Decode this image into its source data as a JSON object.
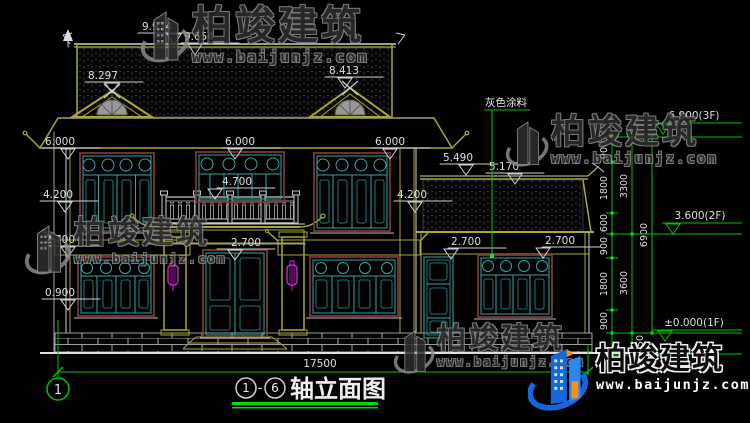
{
  "colors": {
    "background": "#000000",
    "dim_green": "#00c300",
    "roof_yellow": "#a8a832",
    "window_teal": "#31a8a8",
    "frame_maroon": "#7a3535",
    "lantern_magenta": "#e520e5",
    "logo_blue": "#1766d9",
    "logo_orange": "#ff8e0e"
  },
  "watermark": {
    "brand": "柏竣建筑",
    "url": "www.baijunjz.com"
  },
  "logo": {
    "brand": "柏竣建筑",
    "url": "www.baijunjz.com"
  },
  "drawing": {
    "title": {
      "axis_start": "1",
      "dash": "-",
      "axis_end": "6",
      "name": "轴立面图"
    },
    "axis_bubble": "1",
    "paint_label": "灰色涂料",
    "overall_width": "17500",
    "elev": {
      "e9974": "9.974",
      "e9654": "9.654",
      "e8297": "8.297",
      "e8413": "8.413",
      "e6000a": "6.000",
      "e6000b": "6.000",
      "e6000c": "6.000",
      "e4200a": "4.200",
      "e4200b": "4.200",
      "e4700": "4.700",
      "e5490": "5.490",
      "e5170": "5.170",
      "e2700a": "2.700",
      "e2700b": "2.700",
      "e2700c": "2.700",
      "e2700d": "2.700",
      "e0900": "0.900",
      "f3": "6.900(3F)",
      "f2": "3.600(2F)",
      "f1": "±0.000(1F)"
    },
    "chain": {
      "segs": [
        "900",
        "1800",
        "600",
        "900",
        "1800",
        "900"
      ],
      "foot": "450",
      "subs": [
        "3300",
        "3600"
      ],
      "total": "6900"
    }
  }
}
